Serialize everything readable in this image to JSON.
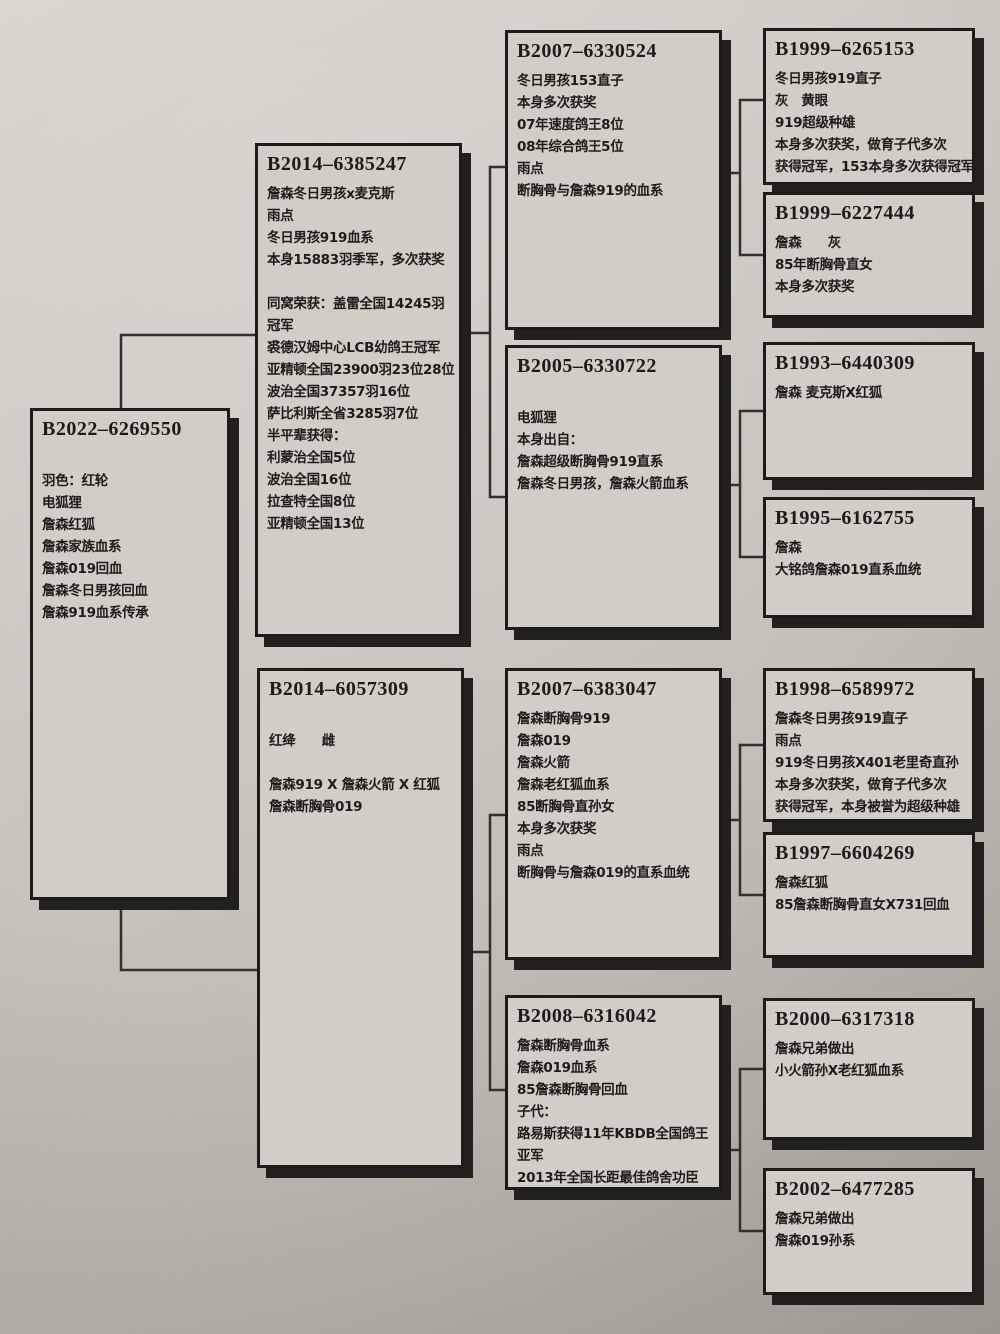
{
  "palette": {
    "paper": "#cbc7bf",
    "box_fill": "#d2cec6",
    "box_border": "#1c1c1a",
    "box_shadow": "#22211e",
    "connector_line": "#33312d",
    "text": "#1d1c1a"
  },
  "pedigree": {
    "boxes": [
      {
        "generation": 1,
        "relation": "subject",
        "ring": "B2022–6269550",
        "lines": [
          "",
          "羽色：红轮",
          "电狐狸",
          "詹森红狐",
          "詹森家族血系",
          "詹森019回血",
          "詹森冬日男孩回血",
          "詹森919血系传承"
        ]
      },
      {
        "generation": 2,
        "relation": "sire",
        "ring": "B2014–6385247",
        "lines": [
          "詹森冬日男孩x麦克斯",
          "雨点",
          "冬日男孩919血系",
          "本身15883羽季军，多次获奖",
          "",
          "同窝荣获：盖雷全国14245羽",
          "冠军",
          "裘德汉姆中心LCB幼鸽王冠军",
          "亚精顿全国23900羽23位28位",
          "波治全国37357羽16位",
          "萨比利斯全省3285羽7位",
          "半平辈获得：",
          "利蒙治全国5位",
          "波治全国16位",
          "拉查特全国8位",
          "亚精顿全国13位"
        ]
      },
      {
        "generation": 2,
        "relation": "dam",
        "ring": "B2014–6057309",
        "lines": [
          "",
          "红绛　　雌",
          "",
          "詹森919 X 詹森火箭 X 红狐",
          "詹森断胸骨019"
        ]
      },
      {
        "generation": 3,
        "relation": "sire-sire",
        "ring": "B2007–6330524",
        "lines": [
          "冬日男孩153直子",
          "本身多次获奖",
          "07年速度鸽王8位",
          "08年综合鸽王5位",
          "雨点",
          "断胸骨与詹森919的血系"
        ]
      },
      {
        "generation": 3,
        "relation": "sire-dam",
        "ring": "B2005–6330722",
        "lines": [
          "",
          "电狐狸",
          "本身出自：",
          "詹森超级断胸骨919直系",
          "詹森冬日男孩，詹森火箭血系"
        ]
      },
      {
        "generation": 3,
        "relation": "dam-sire",
        "ring": "B2007–6383047",
        "lines": [
          "詹森断胸骨919",
          "詹森019",
          "詹森火箭",
          "詹森老红狐血系",
          "85断胸骨直孙女",
          "本身多次获奖",
          "雨点",
          "断胸骨与詹森019的直系血统"
        ]
      },
      {
        "generation": 3,
        "relation": "dam-dam",
        "ring": "B2008–6316042",
        "lines": [
          "詹森断胸骨血系",
          "詹森019血系",
          "85詹森断胸骨回血",
          "子代：",
          "路易斯获得11年KBDB全国鸽王",
          "亚军",
          "2013年全国长距最佳鸽舍功臣"
        ]
      },
      {
        "generation": 4,
        "relation": "sire-sire-sire",
        "ring": "B1999–6265153",
        "lines": [
          "冬日男孩919直子",
          "灰　黄眼",
          "919超级种雄",
          "本身多次获奖，做育子代多次",
          "获得冠军，153本身多次获得冠军"
        ]
      },
      {
        "generation": 4,
        "relation": "sire-sire-dam",
        "ring": "B1999–6227444",
        "lines": [
          "詹森　　灰",
          "85年断胸骨直女",
          "本身多次获奖"
        ]
      },
      {
        "generation": 4,
        "relation": "sire-dam-sire",
        "ring": "B1993–6440309",
        "lines": [
          "詹森 麦克斯X红狐"
        ]
      },
      {
        "generation": 4,
        "relation": "sire-dam-dam",
        "ring": "B1995–6162755",
        "lines": [
          "詹森",
          "大铭鸽詹森019直系血统"
        ]
      },
      {
        "generation": 4,
        "relation": "dam-sire-sire",
        "ring": "B1998–6589972",
        "lines": [
          "詹森冬日男孩919直子",
          "雨点",
          "919冬日男孩X401老里奇直孙",
          "本身多次获奖，做育子代多次",
          "获得冠军，本身被誉为超级种雄"
        ]
      },
      {
        "generation": 4,
        "relation": "dam-sire-dam",
        "ring": "B1997–6604269",
        "lines": [
          "詹森红狐",
          "85詹森断胸骨直女X731回血"
        ]
      },
      {
        "generation": 4,
        "relation": "dam-dam-sire",
        "ring": "B2000–6317318",
        "lines": [
          "詹森兄弟做出",
          "小火箭孙X老红狐血系"
        ]
      },
      {
        "generation": 4,
        "relation": "dam-dam-dam",
        "ring": "B2002–6477285",
        "lines": [
          "詹森兄弟做出",
          "詹森019孙系"
        ]
      }
    ]
  }
}
